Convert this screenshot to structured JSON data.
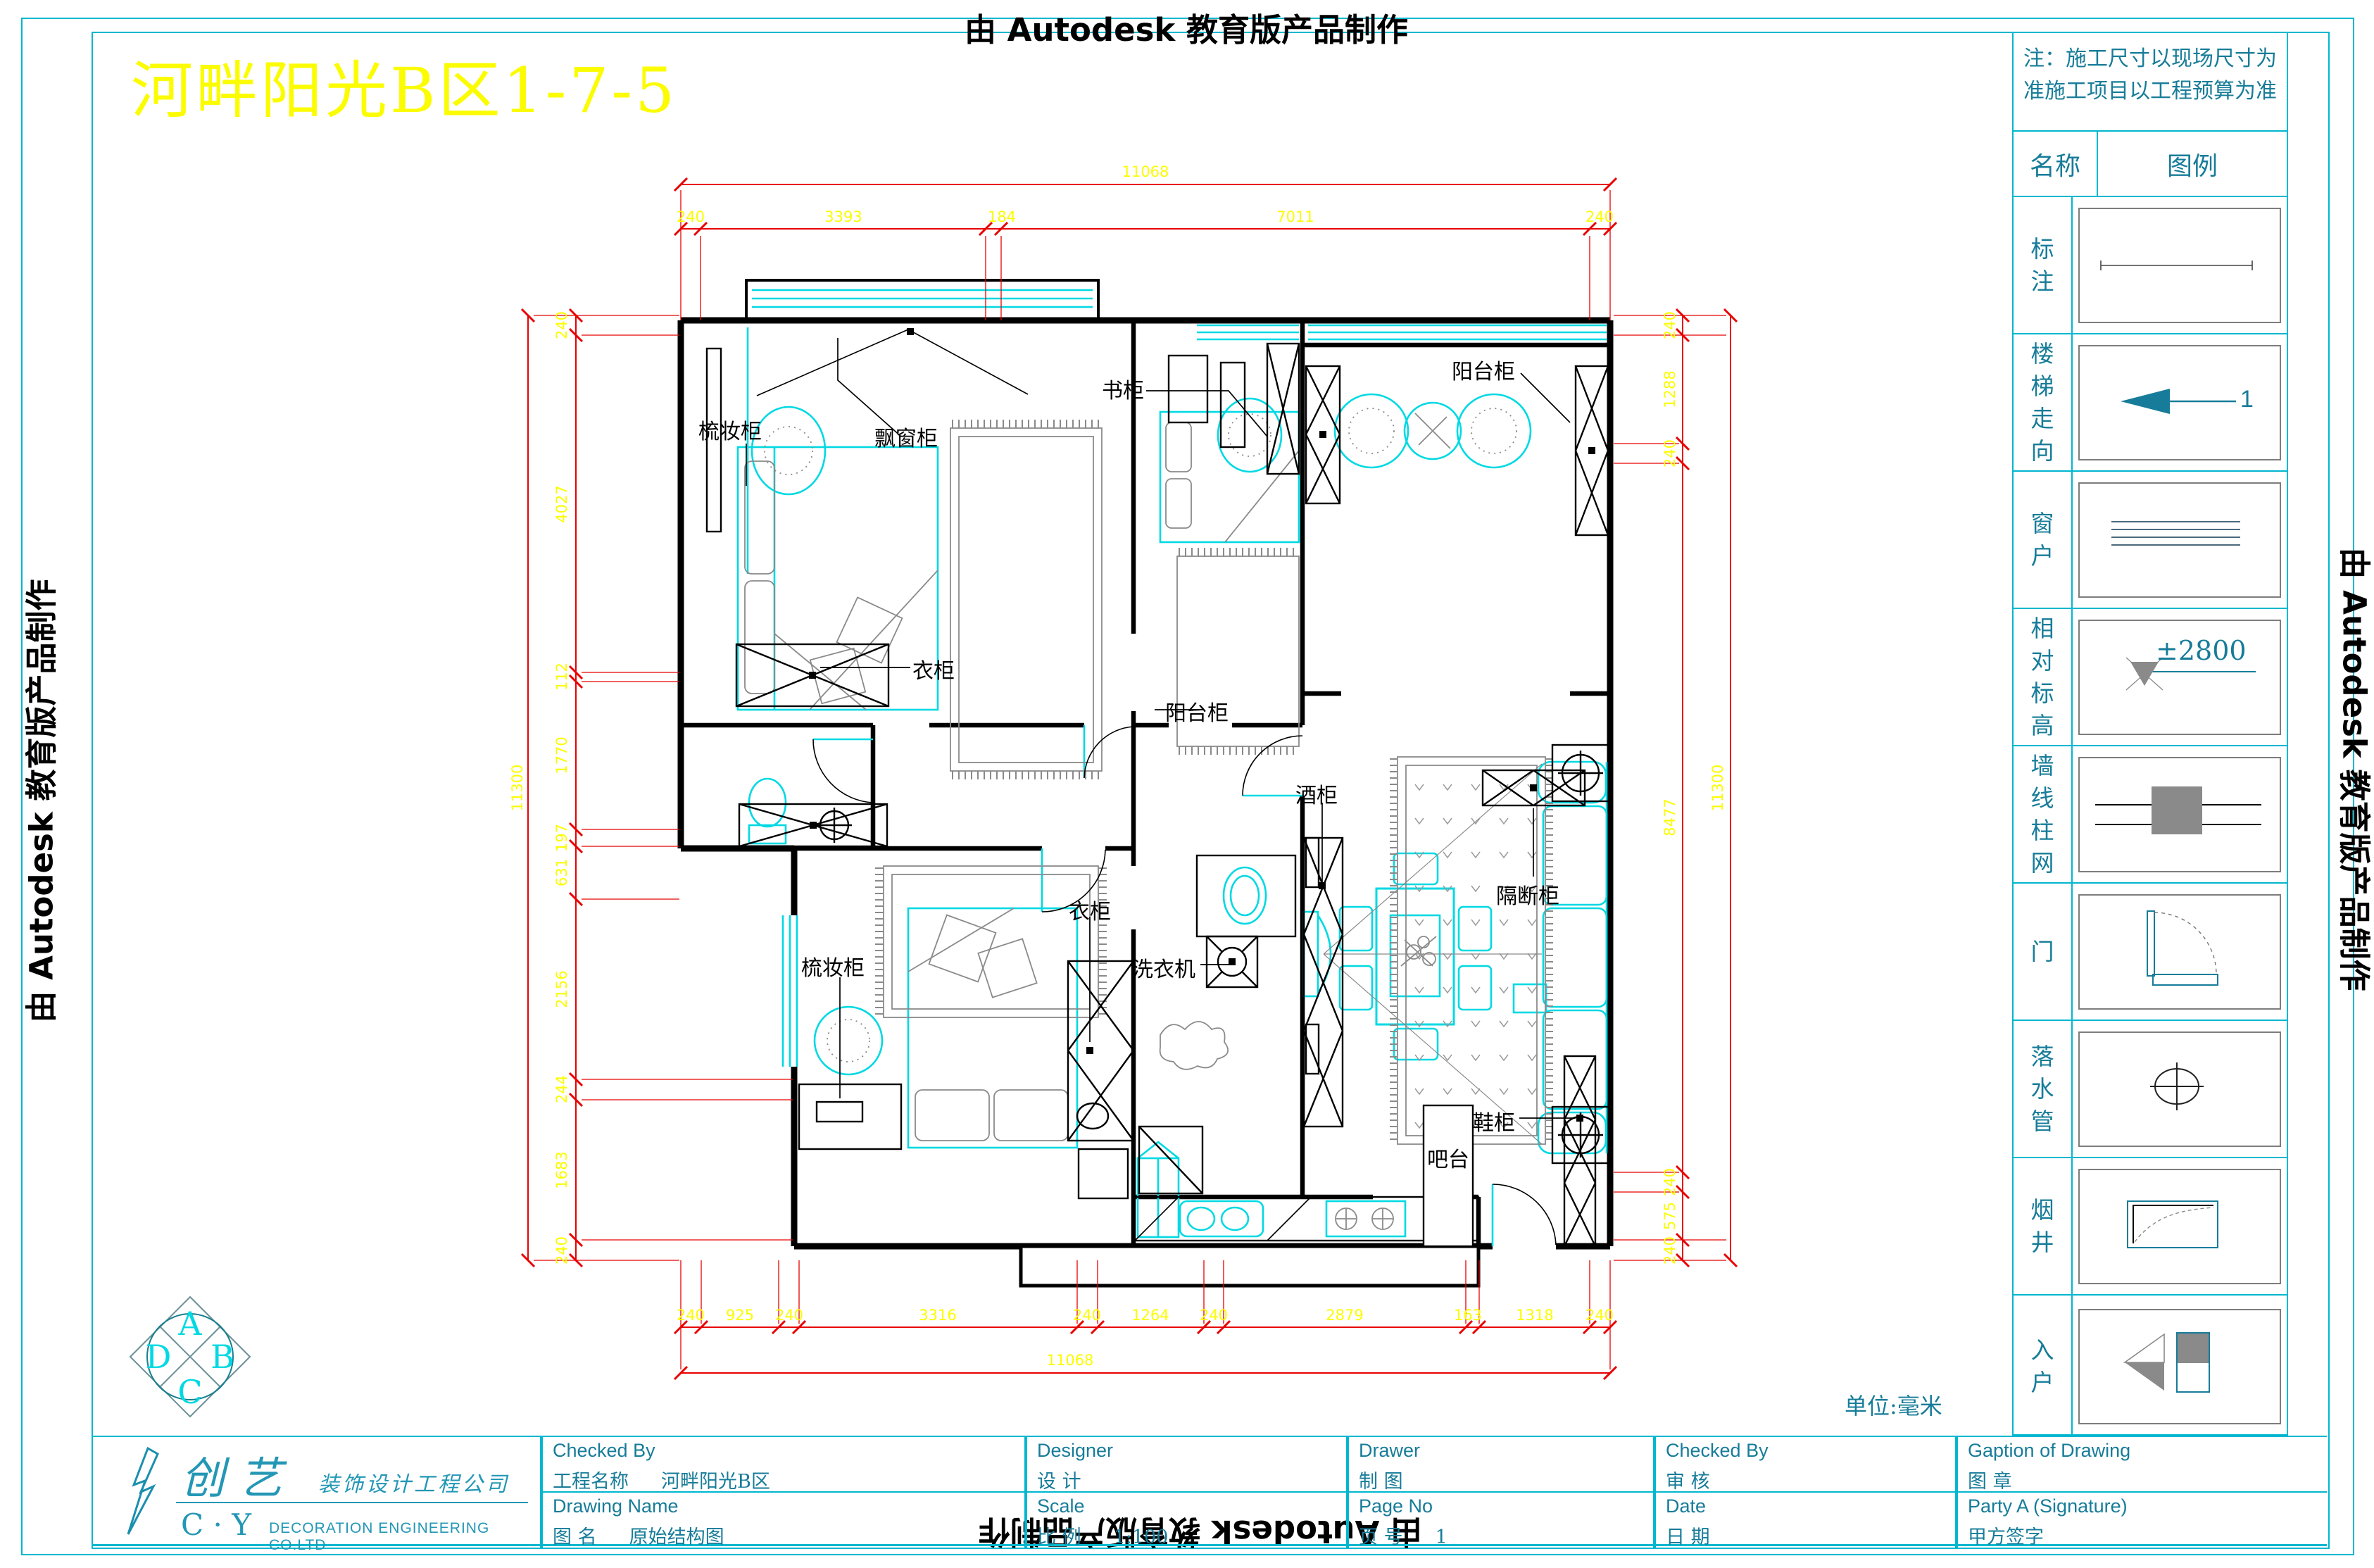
{
  "watermark": {
    "top": "由 Autodesk 教育版产品制作",
    "bottom": "由 Autodesk 教育版产品制作",
    "left": "由 Autodesk 教育版产品制作",
    "right": "由 Autodesk 教育版产品制作"
  },
  "title": {
    "text": "河畔阳光B区1-7-5"
  },
  "sidebar": {
    "note_line1": "注：施工尺寸以现场尺寸为",
    "note_line2": "准施工项目以工程预算为准",
    "header": {
      "name": "名称",
      "legend": "图例"
    },
    "rows": [
      {
        "label": "标注",
        "value": ""
      },
      {
        "label": "楼梯走向",
        "value": "1"
      },
      {
        "label": "窗户",
        "value": ""
      },
      {
        "label": "相对标高",
        "value": "±2800"
      },
      {
        "label": "墙线柱网",
        "value": ""
      },
      {
        "label": "门",
        "value": ""
      },
      {
        "label": "落水管",
        "value": ""
      },
      {
        "label": "烟井",
        "value": ""
      },
      {
        "label": "入户",
        "value": ""
      }
    ]
  },
  "plan": {
    "unit_note": "单位:毫米",
    "labels": [
      {
        "text": "梳妆柜"
      },
      {
        "text": "飘窗柜"
      },
      {
        "text": "书柜"
      },
      {
        "text": "阳台柜"
      },
      {
        "text": "衣柜"
      },
      {
        "text": "阳台柜"
      },
      {
        "text": "酒柜"
      },
      {
        "text": "隔断柜"
      },
      {
        "text": "梳妆柜"
      },
      {
        "text": "衣柜"
      },
      {
        "text": "洗衣机"
      },
      {
        "text": "鞋柜"
      },
      {
        "text": "吧台"
      }
    ],
    "dims": {
      "top_total": "11068",
      "top": [
        "240",
        "3393",
        "184",
        "7011",
        "240"
      ],
      "bottom": [
        "240",
        "925",
        "240",
        "3316",
        "240",
        "1264",
        "240",
        "2879",
        "163",
        "1318",
        "240"
      ],
      "bottom_total": "11068",
      "left": [
        "240",
        "4027",
        "112",
        "1770",
        "197",
        "631",
        "2156",
        "244",
        "1683",
        "240"
      ],
      "left_total": "11300",
      "right": [
        "240",
        "1288",
        "240",
        "8477",
        "240",
        "575",
        "240"
      ],
      "right_total": "11300"
    }
  },
  "title_block": {
    "company": {
      "cn_big": "创 艺",
      "cn_small": "装饰设计工程公司",
      "en_abbr": "C · Y",
      "en": "DECORATION ENGINEERING CO.LTD"
    },
    "cells": [
      {
        "en": "Checked By",
        "zh": "工程名称",
        "value": "河畔阳光B区"
      },
      {
        "en": "Drawing Name",
        "zh": "图  名",
        "value": "原始结构图"
      },
      {
        "en": "Designer",
        "zh": "设  计",
        "value": ""
      },
      {
        "en": "Scale",
        "zh": "比  例",
        "value": "1:100"
      },
      {
        "en": "Drawer",
        "zh": "制  图",
        "value": ""
      },
      {
        "en": "Page No",
        "zh": "页  号",
        "value": "1"
      },
      {
        "en": "Checked By",
        "zh": "审  核",
        "value": ""
      },
      {
        "en": "Date",
        "zh": "日  期",
        "value": ""
      },
      {
        "en": "Gaption of Drawing",
        "zh": "图  章",
        "value": ""
      },
      {
        "en": "Party A  (Signature)",
        "zh": "甲方签字",
        "value": ""
      }
    ]
  },
  "logo": {
    "letters": [
      "A",
      "B",
      "C",
      "D"
    ]
  }
}
